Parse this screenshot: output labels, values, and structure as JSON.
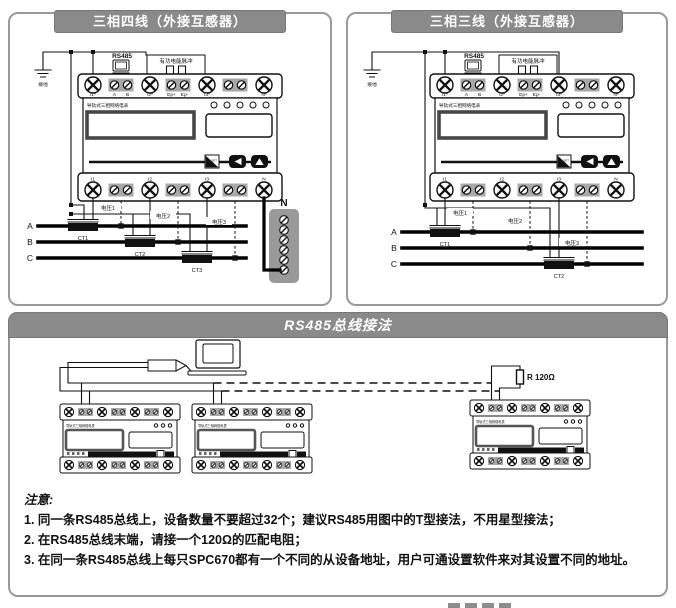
{
  "colors": {
    "panel_border": "#9a9a9a",
    "title_bg": "#8a8a8a",
    "title_text": "#ffffff",
    "line": "#111111",
    "pair_box": "#a8a8a8",
    "strip_bg": "#999999"
  },
  "meter": {
    "brand": "导轨式三相网络电表",
    "set_label": "SET",
    "top_terminals": [
      "I1*",
      "A",
      "B",
      "I2*",
      "Ep+",
      "Ep-",
      "I3*",
      "N*"
    ],
    "bottom_terminals": [
      "I1",
      "I2",
      "I3",
      "N"
    ]
  },
  "four_wire": {
    "title": "三相四线（外接互感器）",
    "ground": "接地",
    "rs485": "RS485",
    "pulse": "有功电能脉冲",
    "phases": [
      "A",
      "B",
      "C"
    ],
    "cts": [
      "CT1",
      "CT2",
      "CT3"
    ],
    "voltages": [
      "电压1",
      "电压2",
      "电压3"
    ],
    "neutral": "N"
  },
  "three_wire": {
    "title": "三相三线（外接互感器）",
    "ground": "接地",
    "rs485": "RS485",
    "pulse": "有功电能脉冲",
    "phases": [
      "A",
      "B",
      "C"
    ],
    "cts": [
      "CT1",
      "CT2"
    ],
    "voltages": [
      "电压1",
      "电压2",
      "电压3"
    ]
  },
  "bus": {
    "title": "RS485总线接法",
    "resistor": "R 120Ω",
    "notes_title": "注意:",
    "notes": [
      "1. 同一条RS485总线上，设备数量不要超过32个；建议RS485用图中的T型接法，不用星型接法；",
      "2. 在RS485总线末端，请接一个120Ω的匹配电阻；",
      "3. 在同一条RS485总线上每只SPC670都有一个不同的从设备地址，用户可通设置软件来对其设置不同的地址。"
    ]
  }
}
